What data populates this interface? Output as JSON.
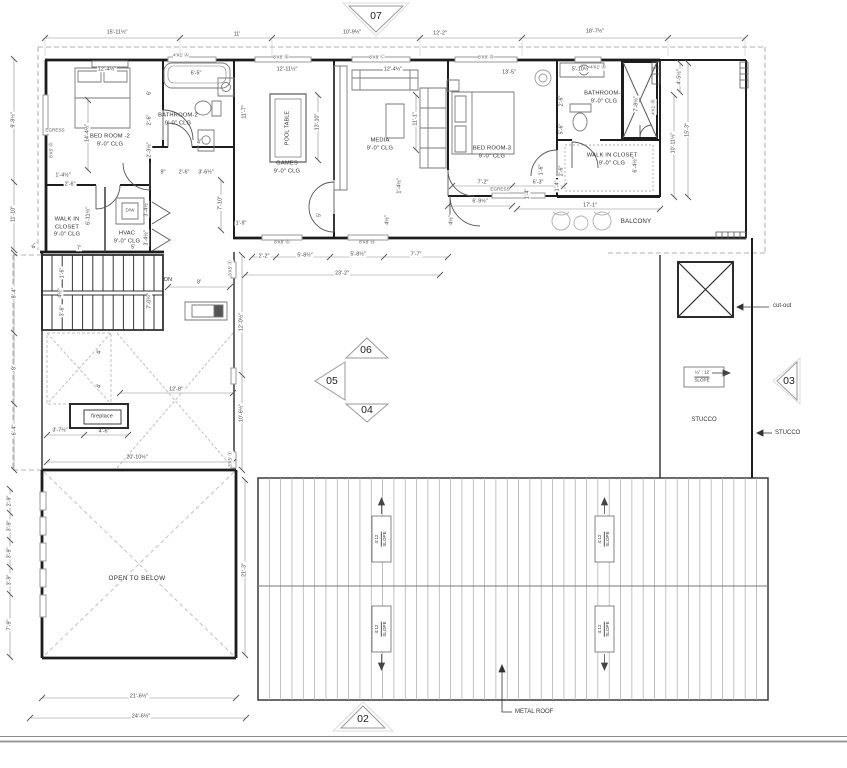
{
  "rooms": {
    "bedroom2": {
      "name": "BED ROOM -2",
      "clg": "9'-0\" CLG"
    },
    "bathroom2": {
      "name": "BATHROOM-2",
      "clg": "9'-0\" CLG"
    },
    "wic_left": {
      "l1": "WALK IN",
      "l2": "CLOSET",
      "clg": "9'-0\" CLG"
    },
    "hvac": {
      "name": "HVAC",
      "clg": "9'-0\" CLG"
    },
    "games": {
      "name": "GAMES",
      "clg": "9'-0\" CLG"
    },
    "media": {
      "name": "MEDIA",
      "clg": "9'-0\" CLG"
    },
    "bedroom3": {
      "name": "BED ROOM-3",
      "clg": "9'-0\" CLG"
    },
    "bathroom3": {
      "name": "BATHROOM-3",
      "clg": "9'-0\" CLG"
    },
    "wic_right": {
      "name": "WALK IN CLOSET",
      "clg": "9'-0\" CLG"
    },
    "pool_table": "POOL TABLE",
    "balcony": "BALCONY",
    "open_below": "OPEN TO BELOW",
    "fireplace": "fireplace"
  },
  "annotations": {
    "dn": "DN",
    "metal_roof": "METAL ROOF",
    "stucco_area": "STUCCO",
    "stucco_leader": "STUCCO",
    "cut_out": "cut-out",
    "flat_slope_ratio": "¼\" : 12",
    "flat_slope_word": "SLOPE",
    "roof_slope_ratio": "4:12",
    "roof_slope_word": "SLOPE"
  },
  "markers": {
    "m02": "02",
    "m03": "03",
    "m04": "04",
    "m05": "05",
    "m06": "06",
    "m07": "07"
  },
  "dims": [
    {
      "t": "15'-11½\"",
      "x": 117,
      "y": 33
    },
    {
      "t": "11'",
      "x": 237,
      "y": 35
    },
    {
      "t": "10'-9½\"",
      "x": 352,
      "y": 33
    },
    {
      "t": "12'-2\"",
      "x": 440,
      "y": 34
    },
    {
      "t": "18'-7½\"",
      "x": 595,
      "y": 32
    },
    {
      "t": "12'-4½\"",
      "x": 107,
      "y": 70
    },
    {
      "t": "6'-5\"",
      "x": 196,
      "y": 74
    },
    {
      "t": "12'-11½\"",
      "x": 287,
      "y": 70
    },
    {
      "t": "12'-4½\"",
      "x": 393,
      "y": 70
    },
    {
      "t": "13'-5\"",
      "x": 509,
      "y": 73
    },
    {
      "t": "5'-10½\"",
      "x": 581,
      "y": 70
    },
    {
      "t": "9'-8½\"",
      "x": 14,
      "y": 120,
      "r": -90
    },
    {
      "t": "11'-10\"",
      "x": 14,
      "y": 214,
      "r": -90
    },
    {
      "t": "8'-4\"",
      "x": 15,
      "y": 293,
      "r": -90
    },
    {
      "t": "8'",
      "x": 15,
      "y": 368,
      "r": -90
    },
    {
      "t": "6'-4\"",
      "x": 15,
      "y": 430,
      "r": -90
    },
    {
      "t": "2'-9\"",
      "x": 10,
      "y": 501,
      "r": -90
    },
    {
      "t": "3'-9\"",
      "x": 10,
      "y": 526,
      "r": -90
    },
    {
      "t": "3'-9\"",
      "x": 10,
      "y": 553,
      "r": -90
    },
    {
      "t": "3'-9\"",
      "x": 10,
      "y": 580,
      "r": -90
    },
    {
      "t": "7'-9\"",
      "x": 10,
      "y": 625,
      "r": -90
    },
    {
      "t": "14'-4½\"",
      "x": 88,
      "y": 133,
      "r": -90
    },
    {
      "t": "6'",
      "x": 150,
      "y": 93,
      "r": -90
    },
    {
      "t": "2'-6\"",
      "x": 150,
      "y": 120,
      "r": -90
    },
    {
      "t": "2'-3½\"",
      "x": 150,
      "y": 150,
      "r": -90
    },
    {
      "t": "1'-4½\"",
      "x": 63,
      "y": 176
    },
    {
      "t": "2'-6\"",
      "x": 70,
      "y": 185
    },
    {
      "t": "9\"",
      "x": 163,
      "y": 173
    },
    {
      "t": "2'-6\"",
      "x": 184,
      "y": 173
    },
    {
      "t": "3'-6½\"",
      "x": 206,
      "y": 173
    },
    {
      "t": "4'",
      "x": 199,
      "y": 143
    },
    {
      "t": "11'-7\"",
      "x": 245,
      "y": 112,
      "r": -90
    },
    {
      "t": "6'-11½\"",
      "x": 89,
      "y": 216,
      "r": -90
    },
    {
      "t": "7'",
      "x": 79,
      "y": 249
    },
    {
      "t": "3'-4½\"",
      "x": 147,
      "y": 209,
      "r": -90
    },
    {
      "t": "3'-4½\"",
      "x": 147,
      "y": 238,
      "r": -90
    },
    {
      "t": "5'",
      "x": 133,
      "y": 248
    },
    {
      "t": "7'-10\"",
      "x": 221,
      "y": 203,
      "r": -90
    },
    {
      "t": "1'-9\"",
      "x": 241,
      "y": 224
    },
    {
      "t": "13'-10\"",
      "x": 318,
      "y": 122,
      "r": -90
    },
    {
      "t": "11'-1\"",
      "x": 416,
      "y": 119,
      "r": -90
    },
    {
      "t": "5'",
      "x": 320,
      "y": 215,
      "r": -90
    },
    {
      "t": "1'-4½\"",
      "x": 400,
      "y": 186,
      "r": -90
    },
    {
      "t": "4½\"",
      "x": 388,
      "y": 220,
      "r": -90
    },
    {
      "t": "2'-2\"",
      "x": 264,
      "y": 257
    },
    {
      "t": "5'-8½\"",
      "x": 305,
      "y": 256
    },
    {
      "t": "5'-8½\"",
      "x": 358,
      "y": 255
    },
    {
      "t": "7'-7\"",
      "x": 416,
      "y": 255
    },
    {
      "t": "23'-2\"",
      "x": 342,
      "y": 274
    },
    {
      "t": "7'-2\"",
      "x": 483,
      "y": 183
    },
    {
      "t": "6'-3\"",
      "x": 538,
      "y": 183
    },
    {
      "t": "6'-9½\"",
      "x": 480,
      "y": 202
    },
    {
      "t": "17'-1\"",
      "x": 590,
      "y": 206
    },
    {
      "t": "1'-6\"",
      "x": 542,
      "y": 170,
      "r": -90
    },
    {
      "t": "1'-4\"",
      "x": 528,
      "y": 194,
      "r": -90
    },
    {
      "t": "4½\"",
      "x": 452,
      "y": 220,
      "r": -90
    },
    {
      "t": "2'-6\"",
      "x": 562,
      "y": 101,
      "r": -90
    },
    {
      "t": "5'-6\"",
      "x": 562,
      "y": 129,
      "r": -90
    },
    {
      "t": "2'-6\"",
      "x": 562,
      "y": 171,
      "r": -90
    },
    {
      "t": "1'-4\"",
      "x": 558,
      "y": 186,
      "r": -90
    },
    {
      "t": "7'-8½\"",
      "x": 637,
      "y": 104,
      "r": -90
    },
    {
      "t": "6'-4½\"",
      "x": 636,
      "y": 165,
      "r": -90
    },
    {
      "t": "10'-11½\"",
      "x": 674,
      "y": 143,
      "r": -90
    },
    {
      "t": "4'-5½\"",
      "x": 680,
      "y": 77,
      "r": -90
    },
    {
      "t": "15'-3\"",
      "x": 688,
      "y": 130,
      "r": -90
    },
    {
      "t": "1'-6\"",
      "x": 63,
      "y": 273,
      "r": -90
    },
    {
      "t": "4½\"",
      "x": 61,
      "y": 293,
      "r": -90
    },
    {
      "t": "3'-6\"",
      "x": 63,
      "y": 311,
      "r": -90
    },
    {
      "t": "7'-0¼\"",
      "x": 150,
      "y": 301,
      "r": -90
    },
    {
      "t": "8'",
      "x": 199,
      "y": 283
    },
    {
      "t": "4'",
      "x": 100,
      "y": 352,
      "r": -90
    },
    {
      "t": "4'",
      "x": 100,
      "y": 386,
      "r": -90
    },
    {
      "t": "12'-8\"",
      "x": 176,
      "y": 390
    },
    {
      "t": "3'-7½\"",
      "x": 60,
      "y": 431
    },
    {
      "t": "4'-6\"",
      "x": 104,
      "y": 432
    },
    {
      "t": "20'-10½\"",
      "x": 137,
      "y": 458
    },
    {
      "t": "6\"",
      "x": 35,
      "y": 247,
      "r": -45
    },
    {
      "t": "12'-0½\"",
      "x": 242,
      "y": 322,
      "r": -90
    },
    {
      "t": "10'-6½\"",
      "x": 242,
      "y": 413,
      "r": -90
    },
    {
      "t": "21'-3\"",
      "x": 245,
      "y": 570,
      "r": -90
    },
    {
      "t": "21'-6½\"",
      "x": 139,
      "y": 697
    },
    {
      "t": "24'-6½\"",
      "x": 141,
      "y": 717
    }
  ],
  "tags": [
    {
      "t": "4'X1' Ⓐ",
      "x": 181,
      "y": 56
    },
    {
      "t": "8'X8' Ⓑ",
      "x": 281,
      "y": 58
    },
    {
      "t": "8'X8' Ⓒ",
      "x": 377,
      "y": 58
    },
    {
      "t": "8'X8' Ⓓ",
      "x": 486,
      "y": 58
    },
    {
      "t": "4'X1' Ⓐ",
      "x": 598,
      "y": 68
    },
    {
      "t": "4'X1' Ⓑ",
      "x": 654,
      "y": 107,
      "r": -90
    },
    {
      "t": "8'X8' Ⓖ",
      "x": 282,
      "y": 243
    },
    {
      "t": "8'X8' Ⓗ",
      "x": 367,
      "y": 243
    },
    {
      "t": "3'X5' Ⓔ",
      "x": 231,
      "y": 268,
      "r": -90
    },
    {
      "t": "3'X5' Ⓔ",
      "x": 231,
      "y": 459,
      "r": -90
    },
    {
      "t": "8'X5' Ⓓ",
      "x": 52,
      "y": 150,
      "r": -90
    },
    {
      "t": "EGRESS",
      "x": 55,
      "y": 131
    },
    {
      "t": "EGRESS",
      "x": 500,
      "y": 190
    },
    {
      "t": "D/W",
      "x": 130,
      "y": 211
    }
  ]
}
